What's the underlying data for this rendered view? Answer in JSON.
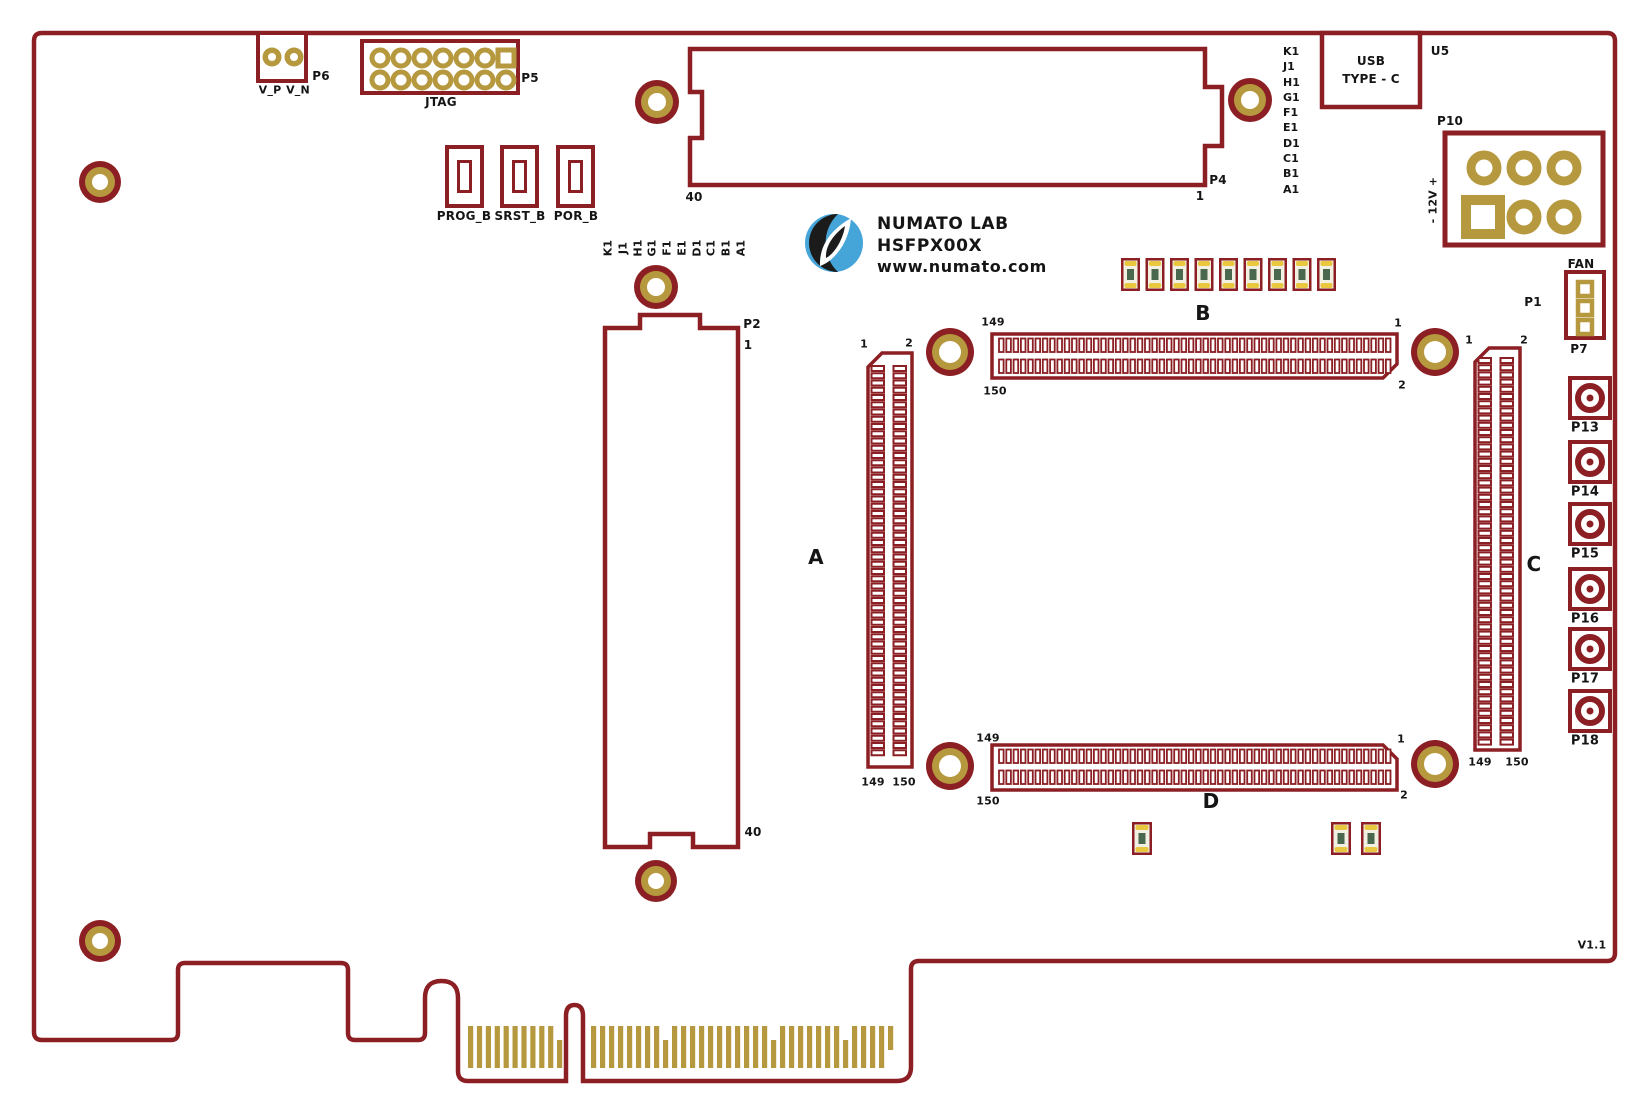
{
  "board": {
    "version": "V1.1",
    "logo": {
      "line1": "NUMATO LAB",
      "line2": "HSFPX00X",
      "line3": "www.numato.com",
      "icon": "numato-leaf-logo"
    },
    "colors": {
      "outline_maroon": "#8B1F23",
      "pad_gold": "#B6993E",
      "logo_blue": "#45A5D9",
      "led_green": "#49684E",
      "led_yellow": "#E9C73F",
      "led_body": "#F2EFE3",
      "text": "#151515"
    },
    "sense_header": {
      "ref": "P6",
      "pins": [
        "V_P",
        "V_N"
      ]
    },
    "jtag": {
      "ref": "P5",
      "label": "JTAG"
    },
    "switches": [
      "PROG_B",
      "SRST_B",
      "POR_B"
    ],
    "p4": {
      "ref": "P4",
      "pin_left": "40",
      "pin_right": "1",
      "signals": [
        "K1",
        "J1",
        "H1",
        "G1",
        "F1",
        "E1",
        "D1",
        "C1",
        "B1",
        "A1"
      ]
    },
    "p2": {
      "ref": "P2",
      "pin_top": "1",
      "pin_bottom": "40",
      "signals": [
        "K1",
        "J1",
        "H1",
        "G1",
        "F1",
        "E1",
        "D1",
        "C1",
        "B1",
        "A1"
      ]
    },
    "usb": {
      "ref": "U5",
      "line1": "USB",
      "line2": "TYPE - C"
    },
    "power_in": {
      "ref": "P10",
      "polarity": "- 12V +"
    },
    "fan": {
      "label": "FAN",
      "ref": "P1",
      "header_ref": "P7"
    },
    "coax_ports": [
      "P13",
      "P14",
      "P15",
      "P16",
      "P17",
      "P18"
    ],
    "module_connectors": {
      "a": {
        "label": "A",
        "pin1": "1",
        "pin2": "2",
        "pin149": "149",
        "pin150": "150"
      },
      "b": {
        "label": "B",
        "pin1": "1",
        "pin2": "2",
        "pin149": "149",
        "pin150": "150"
      },
      "c": {
        "label": "C",
        "pin1": "1",
        "pin2": "2",
        "pin149": "149",
        "pin150": "150"
      },
      "d": {
        "label": "D",
        "pin1": "1",
        "pin2": "2",
        "pin149": "149",
        "pin150": "150"
      }
    },
    "leds": {
      "top_row_count": 9,
      "bottom_count": 3
    }
  }
}
